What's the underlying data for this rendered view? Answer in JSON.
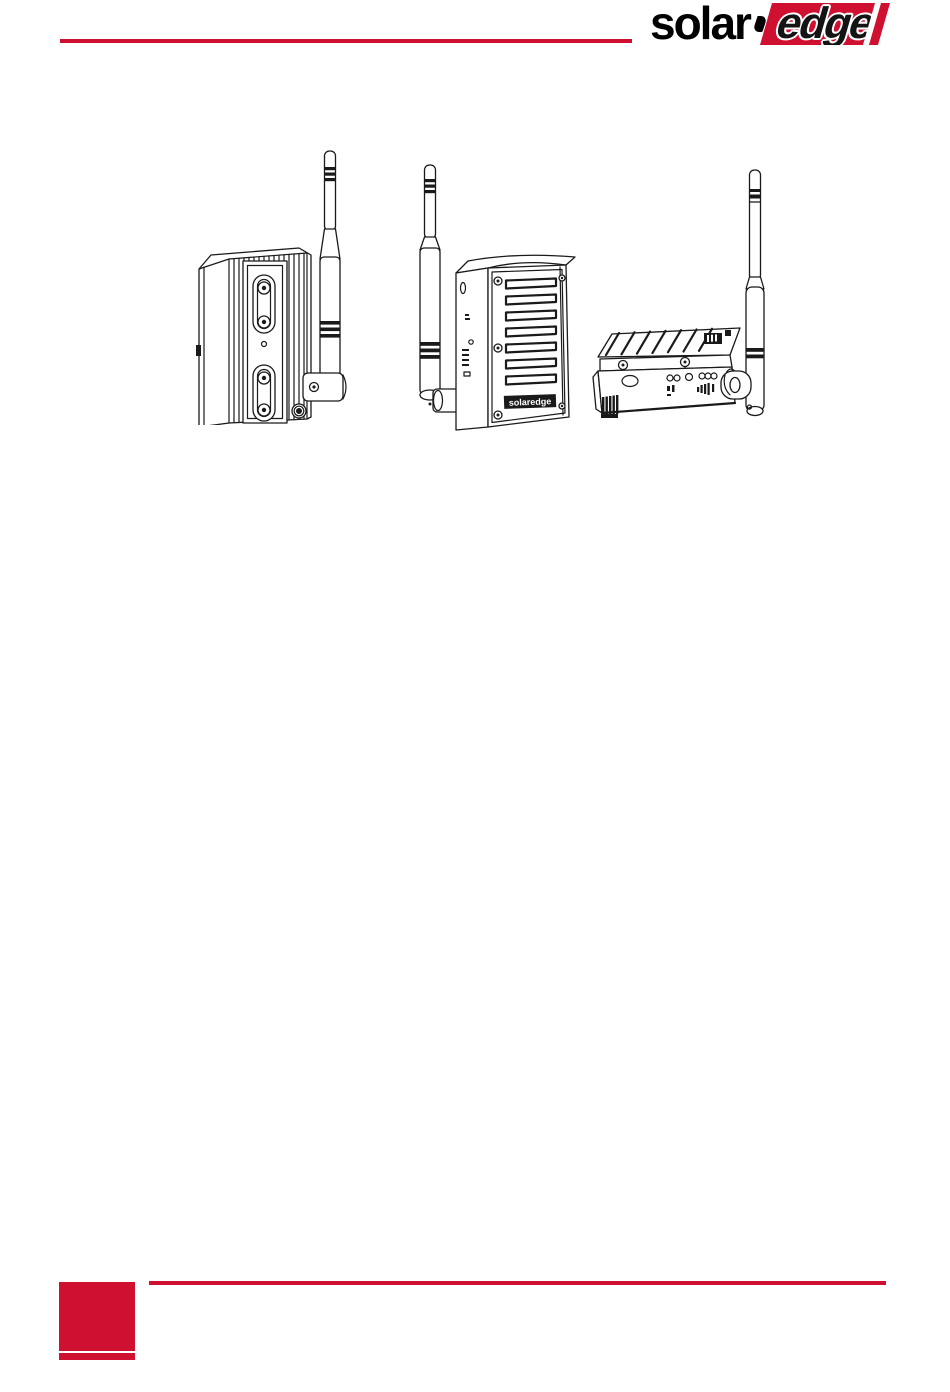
{
  "brand": {
    "red": "#CF1030",
    "ink": "#1A1A1A"
  },
  "header": {
    "logo": {
      "solar": "solar",
      "edge": "edge"
    }
  },
  "illustrations": {
    "left": {
      "name": "inverter-rear-with-antenna-illustration"
    },
    "middle": {
      "name": "vented-interface-box-with-antenna-illustration",
      "mini_logo": "solaredge"
    },
    "right": {
      "name": "horizontal-gateway-with-antenna-illustration"
    }
  },
  "footer": {
    "accent": "#CF1030"
  }
}
